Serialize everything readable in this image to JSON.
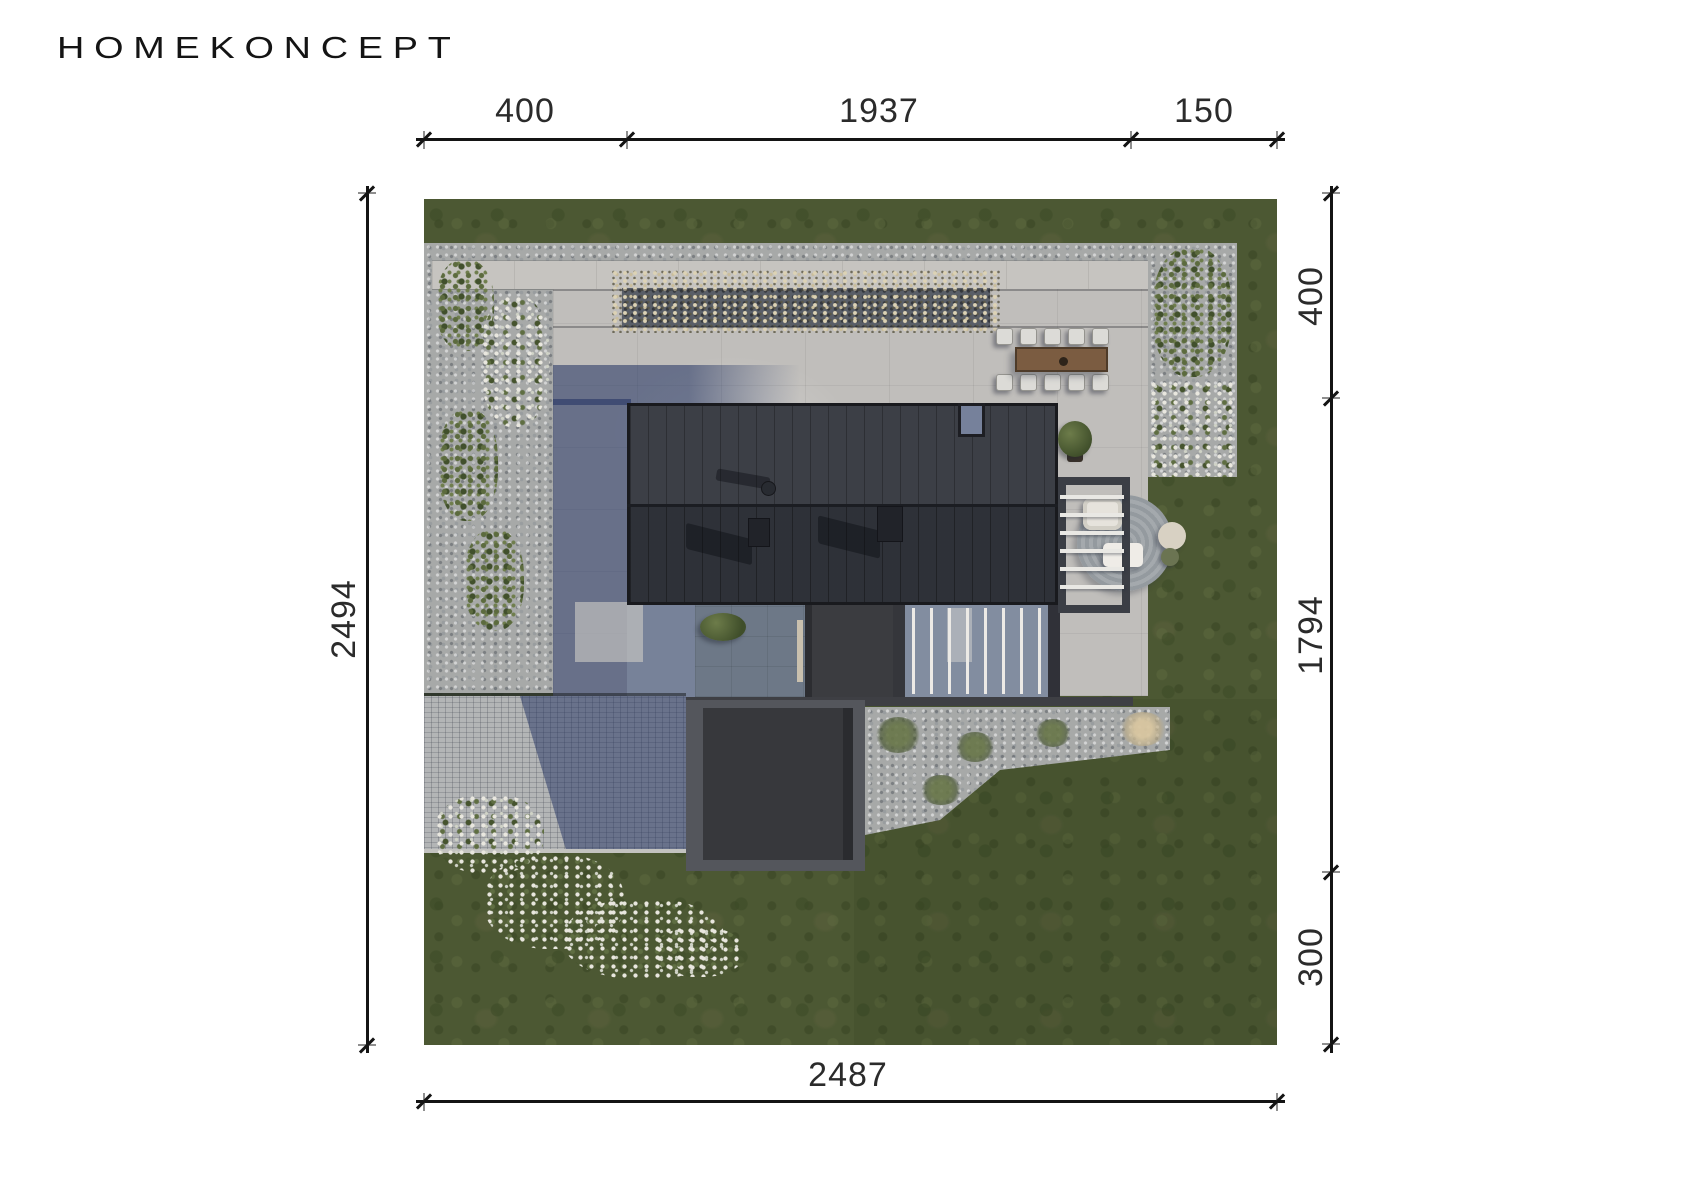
{
  "brand": {
    "logo_text": "HOMEKONCEPT"
  },
  "dimensions": {
    "top": [
      "400",
      "1937",
      "150"
    ],
    "right": [
      "400",
      "1794",
      "300"
    ],
    "left": [
      "2494"
    ],
    "bottom": [
      "2487"
    ]
  },
  "palette": {
    "line_color": "#141414",
    "label_color": "#2b2b2b",
    "lawn_green": "#4c5833",
    "gravel_gray": "#a7a9a8",
    "terrace_concrete": "#c0bebb",
    "roof_charcoal": "#32353c",
    "shadow_blue": "#6b7590",
    "garage_gray": "#54565c",
    "wood_brown": "#7b5c41"
  }
}
